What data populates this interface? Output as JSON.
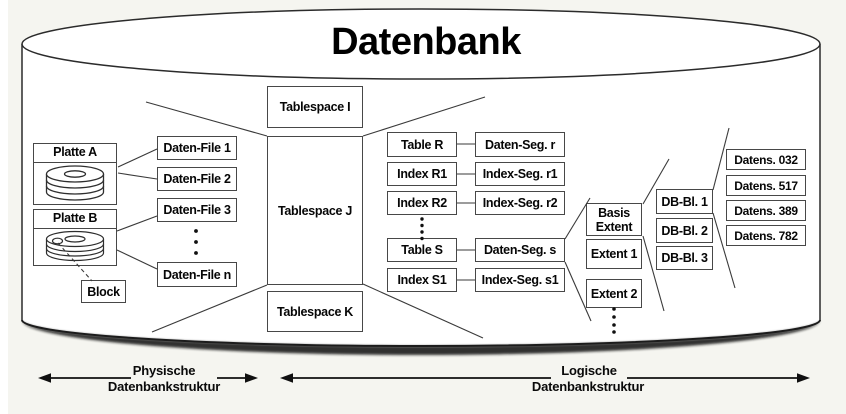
{
  "title": "Datenbank",
  "physical": {
    "platte_a": "Platte A",
    "platte_b": "Platte B",
    "block": "Block",
    "files": [
      "Daten-File 1",
      "Daten-File 2",
      "Daten-File 3",
      "Daten-File n"
    ]
  },
  "tablespaces": [
    "Tablespace I",
    "Tablespace J",
    "Tablespace K"
  ],
  "segments": {
    "rows": [
      {
        "object": "Table R",
        "segment": "Daten-Seg. r"
      },
      {
        "object": "Index R1",
        "segment": "Index-Seg. r1"
      },
      {
        "object": "Index R2",
        "segment": "Index-Seg. r2"
      },
      {
        "object": "Table S",
        "segment": "Daten-Seg. s"
      },
      {
        "object": "Index S1",
        "segment": "Index-Seg. s1"
      }
    ]
  },
  "extents": {
    "basis_line1": "Basis",
    "basis_line2": "Extent",
    "items": [
      "Extent 1",
      "Extent 2"
    ]
  },
  "db_blocks": [
    "DB-Bl. 1",
    "DB-Bl. 2",
    "DB-Bl. 3"
  ],
  "records": [
    "Datens. 032",
    "Datens. 517",
    "Datens. 389",
    "Datens. 782"
  ],
  "legend": {
    "physical_line1": "Physische",
    "physical_line2": "Datenbankstruktur",
    "logical_line1": "Logische",
    "logical_line2": "Datenbankstruktur"
  },
  "colors": {
    "background": "#f5f5f0",
    "cylinder_fill": "#ffffff",
    "line": "#3a3a3a",
    "text": "#060606"
  }
}
